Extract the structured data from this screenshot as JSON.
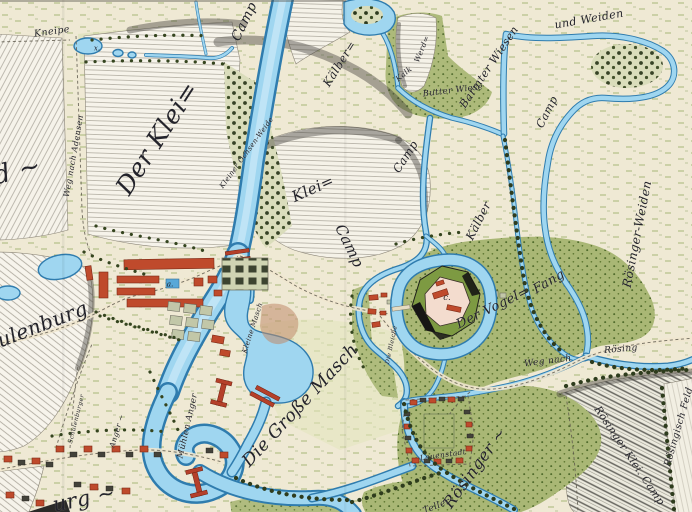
{
  "map": {
    "type": "historical-hand-drawn-map",
    "labels": [
      {
        "id": "kneipe",
        "text": "Kneipe"
      },
      {
        "id": "feld-partial",
        "text": "ld ~"
      },
      {
        "id": "camp-top",
        "text": "Camp"
      },
      {
        "id": "der-klei",
        "text": "Der Klei="
      },
      {
        "id": "weg-nach-adensen",
        "text": "Weg nach Adensen"
      },
      {
        "id": "kleiner-ochsen-weide",
        "text": "Kleiner Ochsen-Weide"
      },
      {
        "id": "klei-mid",
        "text": "Klei="
      },
      {
        "id": "camp-mid",
        "text": "Camp"
      },
      {
        "id": "kaelber-top",
        "text": "Kälber="
      },
      {
        "id": "camp-kaelber",
        "text": "Camp"
      },
      {
        "id": "werd",
        "text": "Werd="
      },
      {
        "id": "kalk",
        "text": "Kalk"
      },
      {
        "id": "butter-wiese",
        "text": "Butter Wiese"
      },
      {
        "id": "barmter-wiesen",
        "text": "Barmter Wiesen"
      },
      {
        "id": "und-weiden",
        "text": "und Weiden"
      },
      {
        "id": "camp-ne",
        "text": "Camp"
      },
      {
        "id": "kaelber-mid",
        "text": "Kälber"
      },
      {
        "id": "roesinger-weiden",
        "text": "Rösinger-Weiden"
      },
      {
        "id": "schulenburg",
        "text": "Schulenburg"
      },
      {
        "id": "kleine-masch",
        "text": "Kleine Masch"
      },
      {
        "id": "die-grosse-masch",
        "text": "Die Große Masch"
      },
      {
        "id": "muehlen-anger",
        "text": "Mühlen Anger"
      },
      {
        "id": "anger",
        "text": "Anger ~"
      },
      {
        "id": "schulenburger",
        "text": "Schulenburger"
      },
      {
        "id": "burg-partial",
        "text": "urg ~"
      },
      {
        "id": "der-vogel",
        "text": "Der Vogel="
      },
      {
        "id": "fang",
        "text": "Fang"
      },
      {
        "id": "die-bleiche",
        "text": "Die Bleiche"
      },
      {
        "id": "weg-nach",
        "text": "Weg nach"
      },
      {
        "id": "roesing",
        "text": "Rösing"
      },
      {
        "id": "roesinger",
        "text": "Rösinger ~"
      },
      {
        "id": "roesinger-klei-camp",
        "text": "Rösinger Klei. Camp"
      },
      {
        "id": "roesingisch-feld",
        "text": "Rösingisch Feld"
      },
      {
        "id": "lauenstadt",
        "text": "Lauenstadt"
      },
      {
        "id": "teller-partial",
        "text": "Teller"
      }
    ],
    "markers": [
      {
        "id": "pond-x",
        "text": "x."
      },
      {
        "id": "estate-a",
        "text": "a."
      },
      {
        "id": "fort-c",
        "text": "c."
      }
    ],
    "colors": {
      "parchment": "#efe9d4",
      "meadow_tick_green": "#85a04c",
      "dense_green": "#a9b775",
      "river_blue": "#9fd6f0",
      "river_outline": "#2f7cae",
      "building_red": "#bf4a2c",
      "rampart_green": "#7d9a42",
      "hatch_grey": "#9a9488",
      "ink": "#23232b"
    }
  }
}
